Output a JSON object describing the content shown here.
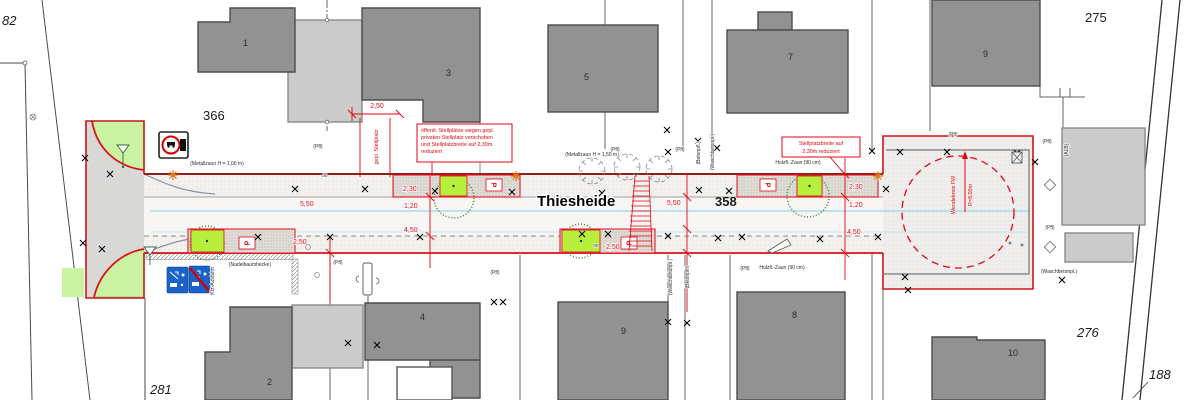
{
  "plan": {
    "street_name": "Thiesheide",
    "parcels": {
      "nw": "82",
      "w": "366",
      "sw": "281",
      "c": "358",
      "ne": "275",
      "e": "276",
      "se": "188"
    },
    "buildings": {
      "b1": "1",
      "b2": "2",
      "b3": "3",
      "b4": "4",
      "b5": "5",
      "b7": "7",
      "b8": "8",
      "b9n": "9",
      "b9s": "9",
      "b10": "10"
    },
    "dims": {
      "d250_top": "2,50",
      "d230_w": "2,30",
      "d120_w": "1,20",
      "d550_w": "5,50",
      "d250_sw": "2,50",
      "d450_s": "4,50",
      "d550_c": "5,50",
      "d250_c": "2,50",
      "d230_e": "2,30",
      "d120_e": "1,20",
      "d450_e": "4,50"
    },
    "notes": {
      "relocation": {
        "lines": [
          "öffentl. Stellplätze wegen gepl.",
          "privaten Stellplatz verschoben",
          "und Stellplatzbreite auf 2,30m",
          "reduziert"
        ]
      },
      "reduction": {
        "lines": [
          "Stellplatzbreite auf",
          "2,30m reduziert"
        ]
      },
      "gepl_stellplatz": "gepl. Stellplatz",
      "wendekreis": "Wendekreis FW",
      "wendekreis_r": "R=8,00m",
      "kfz_ausfahrt": "Kfz-Ausfahrt"
    },
    "labels": {
      "metallzaun_100": "(Metallzaun H = 1,00 m)",
      "metallzaun_150": "(Metallzaun H = 1,50 m)",
      "holzzaun": "Holzfl.-Zaun (90 cm)",
      "nadelbaumhecke": "(Nadelbaumhecke)",
      "pfl": "(Pfl)",
      "waschbetonpl": "(Waschbetonpl.)",
      "betonpfl": "(Betonpfl.)",
      "alb": "(ALB)",
      "oo": "oo",
      "parking_p": "P"
    },
    "colors": {
      "property_line_red": "#c8141e",
      "dim_red": "#e30613",
      "green_box": "#b6ef3c",
      "green_triangle": "#c9f2a2",
      "blue_sign": "#1a63c8",
      "cyan_line": "#9ad6e0",
      "building_dark": "#929292",
      "building_light": "#cbcbcb",
      "lamp_orange": "#e07a1e"
    }
  }
}
